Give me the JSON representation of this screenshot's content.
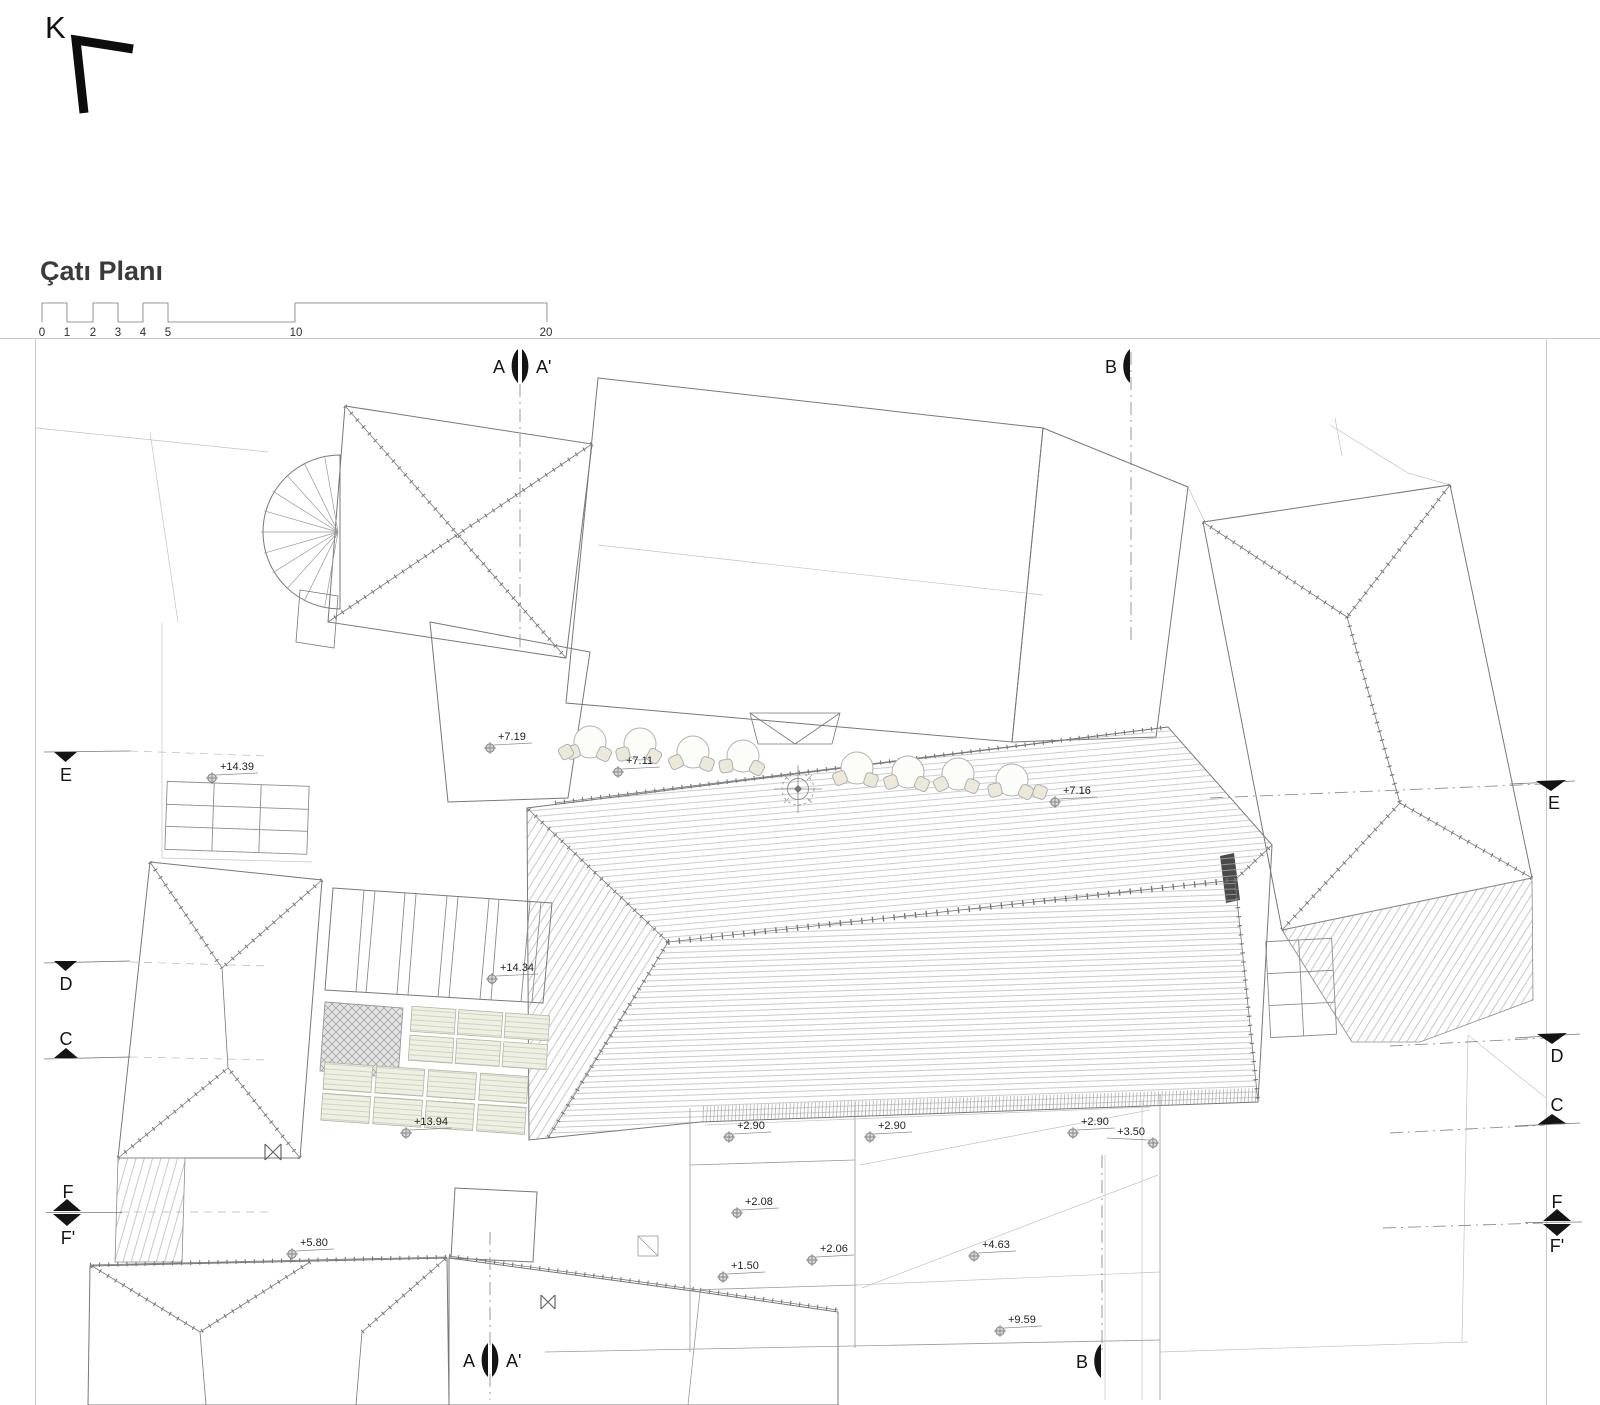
{
  "header": {
    "north_label": "K",
    "title": "Çatı Planı"
  },
  "scalebar": {
    "ticks": [
      "0",
      "1",
      "2",
      "3",
      "4",
      "5",
      "10",
      "20"
    ]
  },
  "sections": {
    "a_top": {
      "left": "A",
      "right": "A'"
    },
    "b_top": {
      "label": "B"
    },
    "a_bottom": {
      "left": "A",
      "right": "A'"
    },
    "b_bottom": {
      "label": "B"
    },
    "e_left": {
      "label": "E"
    },
    "e_right": {
      "label": "E"
    },
    "d_left": {
      "label": "D"
    },
    "d_right": {
      "label": "D"
    },
    "c_left": {
      "label": "C"
    },
    "c_right": {
      "label": "C"
    },
    "f_left": {
      "top": "F",
      "bottom": "F'"
    },
    "f_right": {
      "top": "F",
      "bottom": "F'"
    }
  },
  "elevations": [
    {
      "value": "+14.39"
    },
    {
      "value": "+7.19"
    },
    {
      "value": "+7.11"
    },
    {
      "value": "+7.16"
    },
    {
      "value": "+14.34"
    },
    {
      "value": "+13.94"
    },
    {
      "value": "+2.90"
    },
    {
      "value": "+2.90"
    },
    {
      "value": "+2.90"
    },
    {
      "value": "+3.50"
    },
    {
      "value": "+2.08"
    },
    {
      "value": "+2.06"
    },
    {
      "value": "+4.63"
    },
    {
      "value": "+1.50"
    },
    {
      "value": "+5.80"
    },
    {
      "value": "+9.59"
    }
  ]
}
